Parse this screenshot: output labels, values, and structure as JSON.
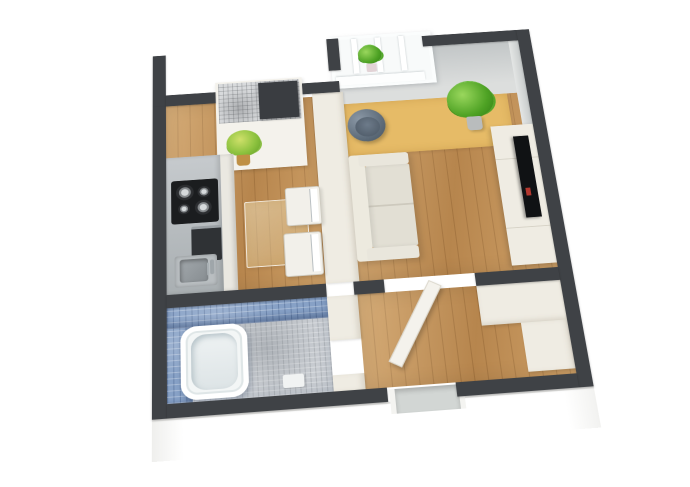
{
  "scene": {
    "title": "3D isometric floor plan of a studio apartment",
    "view": "axonometric top-down cutaway",
    "background": "#ffffff",
    "rooms": [
      {
        "name": "kitchen",
        "floor": "wood",
        "items": [
          "gray-counter",
          "black-cooktop-4-burners",
          "oven",
          "sink-with-faucet",
          "glass-dining-table",
          "white-chair",
          "white-chair",
          "potted-plant",
          "mosaic-niche-unit",
          "dark-appliance-box"
        ]
      },
      {
        "name": "living-room",
        "floor": "wood",
        "items": [
          "window-with-plant-on-sill",
          "tan-rug",
          "gray-tub-chair",
          "green-potted-plant",
          "cream-sofa",
          "tv-cabinet",
          "flat-screen-tv"
        ]
      },
      {
        "name": "bathroom",
        "floor": "gray-mosaic-tile",
        "walls": "blue-mosaic-tile",
        "items": [
          "white-bathtub",
          "bath-mat"
        ]
      },
      {
        "name": "hallway",
        "floor": "wood",
        "items": [
          "open-white-door",
          "wardrobe-closet",
          "wardrobe-closet",
          "entrance-door"
        ]
      }
    ]
  },
  "colors": {
    "wall": "#3f4246",
    "wood": "#c6955a",
    "rug": "#e6bb67",
    "cream": "#efece3",
    "creamShade": "#d8d3c6",
    "grayFace": "#ccd0d0",
    "counter": "#a9afb2",
    "cooktop": "#1b1d1f",
    "bathTile": "#87a1c6",
    "bathFloor": "#c9cdd2",
    "sofa": "#e9e6dc",
    "chairGray": "#5c6a78",
    "plant": "#4ea224",
    "tv": "#101214",
    "window": "#f8fafa",
    "door": "#f4f2ec",
    "entrance": "#d2d6d4",
    "pot": "#bf9045"
  }
}
